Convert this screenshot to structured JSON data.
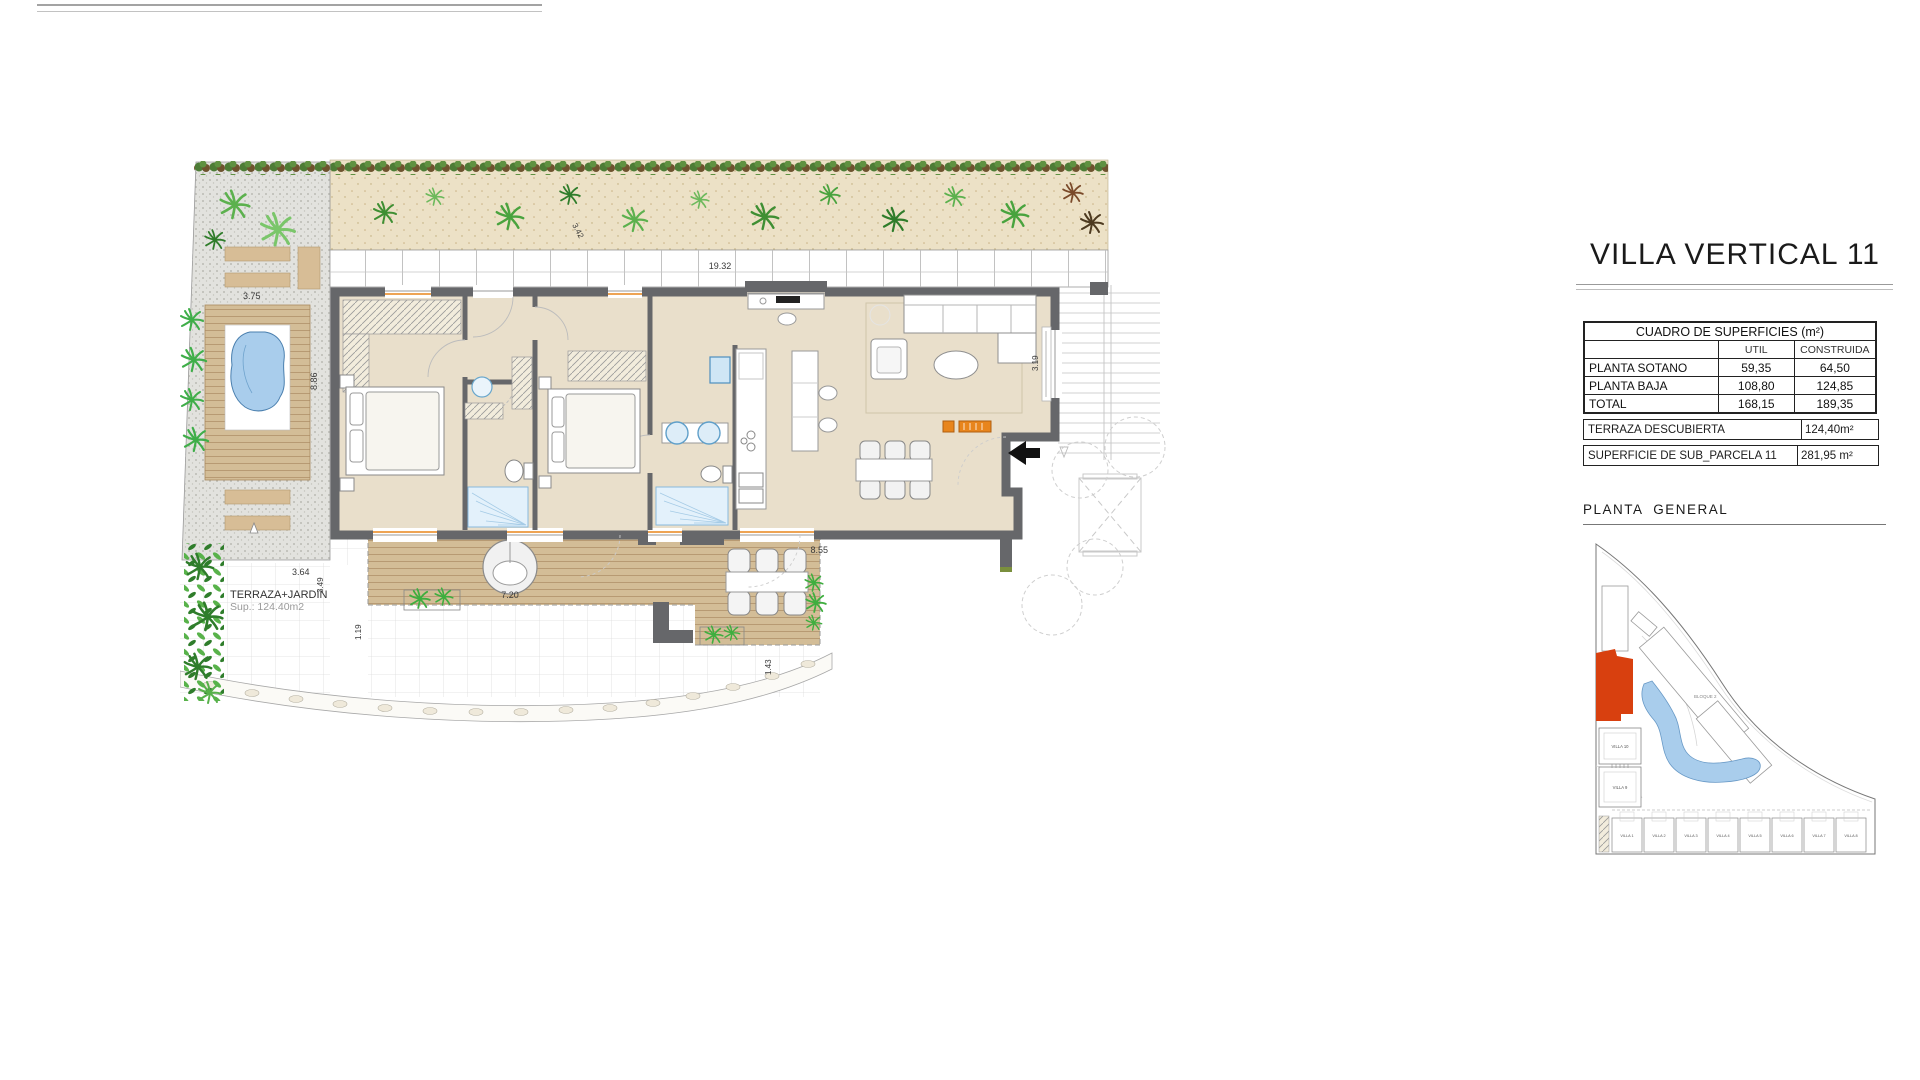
{
  "panel": {
    "title": "VILLA VERTICAL 11",
    "surfaces_table": {
      "title": "CUADRO DE SUPERFICIES (m²)",
      "col_util": "UTIL",
      "col_construida": "CONSTRUIDA",
      "rows": [
        {
          "label": "PLANTA SOTANO",
          "util": "59,35",
          "construida": "64,50"
        },
        {
          "label": "PLANTA BAJA",
          "util": "108,80",
          "construida": "124,85"
        },
        {
          "label": "TOTAL",
          "util": "168,15",
          "construida": "189,35"
        }
      ]
    },
    "terraza": {
      "label": "TERRAZA DESCUBIERTA",
      "value": "124,40m²"
    },
    "parcela": {
      "label": "SUPERFICIE DE SUB_PARCELA  11",
      "value": "281,95 m²"
    },
    "site_plan": {
      "heading": "PLANTA  GENERAL",
      "bloque_label": "BLOQUE 2",
      "villas_left": [
        "VILLA 10",
        "VILLA 9"
      ],
      "villas_bottom": [
        "VILLA 1",
        "VILLA 2",
        "VILLA 3",
        "VILLA 4",
        "VILLA 5",
        "VILLA 6",
        "VILLA 7",
        "VILLA 8"
      ],
      "highlight_color": "#d8400f",
      "pool_color": "#a9cdec"
    }
  },
  "floor_plan": {
    "terrace_label": "TERRAZA+JARDIN",
    "terrace_area": "Sup.: 124.40m2",
    "dims": {
      "paving_width": "19.32",
      "sand_diag": "3.42",
      "pool_deck_width": "3.75",
      "pool_deck_height": "8.86",
      "terrace_a": "3.64",
      "terrace_b": "3.49",
      "terrace_c": "1.19",
      "terrace_d": "7.20",
      "terrace_e": "8.55",
      "path_width": "1.43",
      "living_depth": "3.19"
    },
    "colors": {
      "wall": "#66676a",
      "floor": "#e9dfcb",
      "deck": "#d3bd97",
      "sand": "#ece1c6",
      "water": "#a9cdec",
      "accent_orange": "#e8851c"
    }
  }
}
